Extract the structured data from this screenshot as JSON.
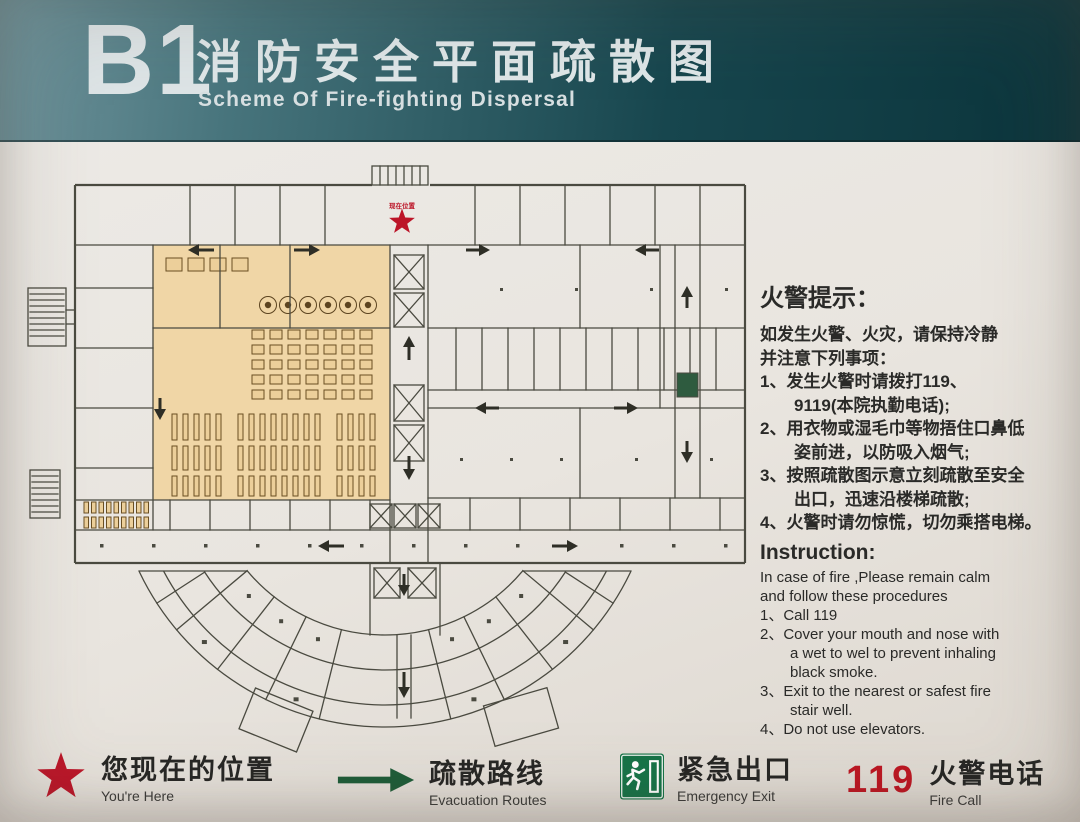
{
  "header": {
    "floor": "B1",
    "title_zh": "消防安全平面疏散图",
    "title_en": "Scheme Of Fire-fighting Dispersal"
  },
  "plan": {
    "star_label": "现在位置"
  },
  "notice": {
    "title": "火警提示：",
    "lines": [
      "如发生火警、火灾，请保持冷静",
      "并注意下列事项：",
      "1、发生火警时请拨打119、",
      "9119(本院执勤电话);",
      "2、用衣物或湿毛巾等物捂住口鼻低",
      "姿前进，以防吸入烟气;",
      "3、按照疏散图示意立刻疏散至安全",
      "出口，迅速沿楼梯疏散;",
      "4、火警时请勿惊慌，切勿乘搭电梯。"
    ]
  },
  "instruction": {
    "title": "Instruction:",
    "lines": [
      "In case of fire ,Please remain calm",
      "and follow these procedures",
      "1、Call 119",
      "2、Cover your mouth and nose with",
      "a wet to wel to prevent inhaling",
      "black smoke.",
      "3、Exit to the nearest or safest fire",
      "stair well.",
      "4、Do not use elevators."
    ]
  },
  "legend": [
    {
      "icon": "you-are-here-star-icon",
      "label_zh": "您现在的位置",
      "label_en": "You're Here"
    },
    {
      "icon": "evacuation-arrow-icon",
      "label_zh": "疏散路线",
      "label_en": "Evacuation Routes"
    },
    {
      "icon": "emergency-exit-icon",
      "label_zh": "紧急出口",
      "label_en": "Emergency Exit"
    },
    {
      "icon": "fire-call-119-badge",
      "badge": "119",
      "label_zh": "火警电话",
      "label_en": "Fire Call"
    }
  ],
  "colors": {
    "header_teal_dark": "#0b343b",
    "header_teal_light": "#70949c",
    "highlight_tan": "#f0d5a2",
    "star_red": "#bc1528",
    "route_green": "#1e5c38",
    "exit_green": "#167347",
    "call_red": "#bc1622",
    "wall": "#4a4a40"
  }
}
